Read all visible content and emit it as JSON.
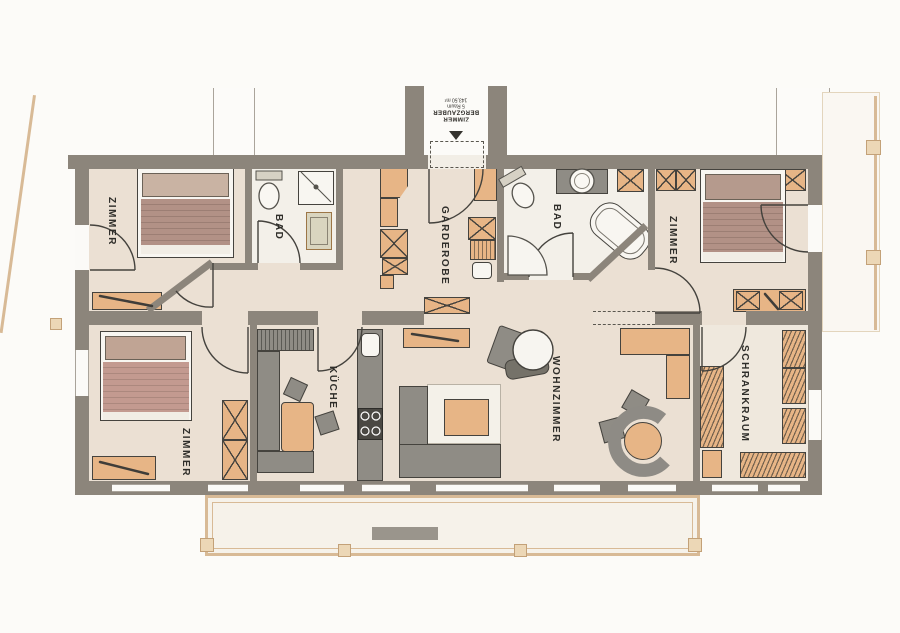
{
  "document": {
    "type": "apartment-floor-plan",
    "style": "scanned architectural drawing"
  },
  "rooms": {
    "zimmer_top_left": {
      "label": "ZIMMER"
    },
    "bad_left": {
      "label": "BAD"
    },
    "garderobe": {
      "label": "GARDEROBE"
    },
    "bad_right": {
      "label": "BAD"
    },
    "zimmer_top_right": {
      "label": "ZIMMER"
    },
    "zimmer_bottom_left": {
      "label": "ZIMMER"
    },
    "kueche": {
      "label": "KÜCHE"
    },
    "wohnzimmer": {
      "label": "WOHNZIMMER"
    },
    "schrankraum": {
      "label": "SCHRANKRAUM"
    }
  },
  "entrance_stamp": {
    "line1": "ZIMMER",
    "line2": "BERGZAUBER",
    "line3": "5 Raum",
    "line4": "143,50 m²"
  },
  "colors": {
    "wall": "#8c857b",
    "floor": "#ebe0d3",
    "bath_floor": "#f3f0e9",
    "furniture_wood": "#e7b586",
    "furniture_gray": "#8f8c85",
    "bed_blanket": "#b29186",
    "railing": "#d8ba96"
  }
}
